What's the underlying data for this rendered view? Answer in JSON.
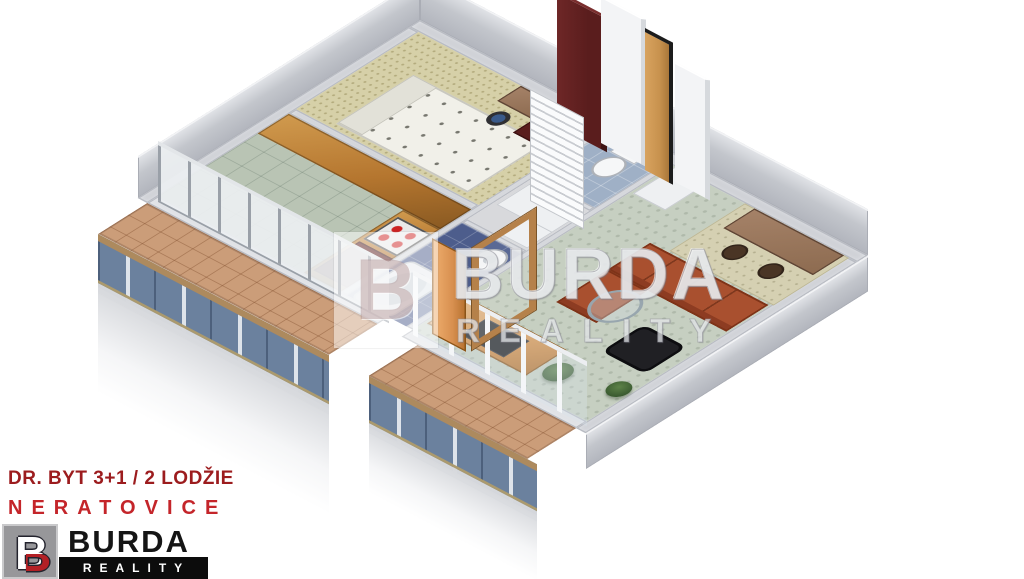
{
  "caption": {
    "line1": "DR. BYT 3+1 / 2 LODŽIE",
    "line2": "NERATOVICE"
  },
  "brand": {
    "name": "BURDA",
    "subtitle": "REALITY",
    "monogram": "B"
  },
  "watermark": {
    "line1": "BURDA",
    "line2": "REALITY",
    "monogram": "B"
  },
  "colors": {
    "brand-dark-red": "#9c1c1e",
    "brand-red": "#c4252a",
    "logo-red": "#b32025",
    "logo-gray": "#97979a",
    "wall": "#cfd1d6",
    "floor-bedroom": "#d6d0a8",
    "floor-kitchen": "#b9c4b4",
    "floor-living": "#c6cfc1",
    "floor-hall": "#d8d9dc",
    "floor-bath": "#4d5d8c",
    "floor-wc": "#9fb0c6",
    "balcony-tile": "#cb9d79",
    "railing-glass": "#6b819e",
    "oak": "#b5762f",
    "mahogany": "#5a1d1d",
    "sofa": "#a9502f",
    "sideboard": "#d58a3c",
    "desk": "#8d6b50",
    "plant": "#3a5a30"
  },
  "plan": {
    "view": "3d-isometric-floor-plan",
    "rooms": [
      {
        "name": "bedroom",
        "floor": "beige-speckled-carpet"
      },
      {
        "name": "kitchen",
        "floor": "green-marble-tile"
      },
      {
        "name": "hall",
        "floor": "gray"
      },
      {
        "name": "wc",
        "floor": "light-blue-tile"
      },
      {
        "name": "bathroom",
        "floor": "dark-blue-tile"
      },
      {
        "name": "living-room",
        "floor": "green-gray-carpet"
      },
      {
        "name": "loggia-left",
        "floor": "terracotta-tile"
      },
      {
        "name": "loggia-right",
        "floor": "terracotta-tile"
      }
    ],
    "furniture": [
      "bed",
      "mahogany-wardrobe",
      "desk",
      "office-chair",
      "kitchen-cabinets",
      "stove",
      "red-cabinet",
      "toilet",
      "washing-machine",
      "bathtub",
      "hall-wardrobe",
      "louver-closet",
      "corner-sofa",
      "black-armchair",
      "glass-coffee-table",
      "tv-sideboard",
      "tv",
      "plants",
      "work-desk",
      "chairs",
      "white-shelf",
      "wooden-entry-door",
      "balcony-railings"
    ]
  }
}
